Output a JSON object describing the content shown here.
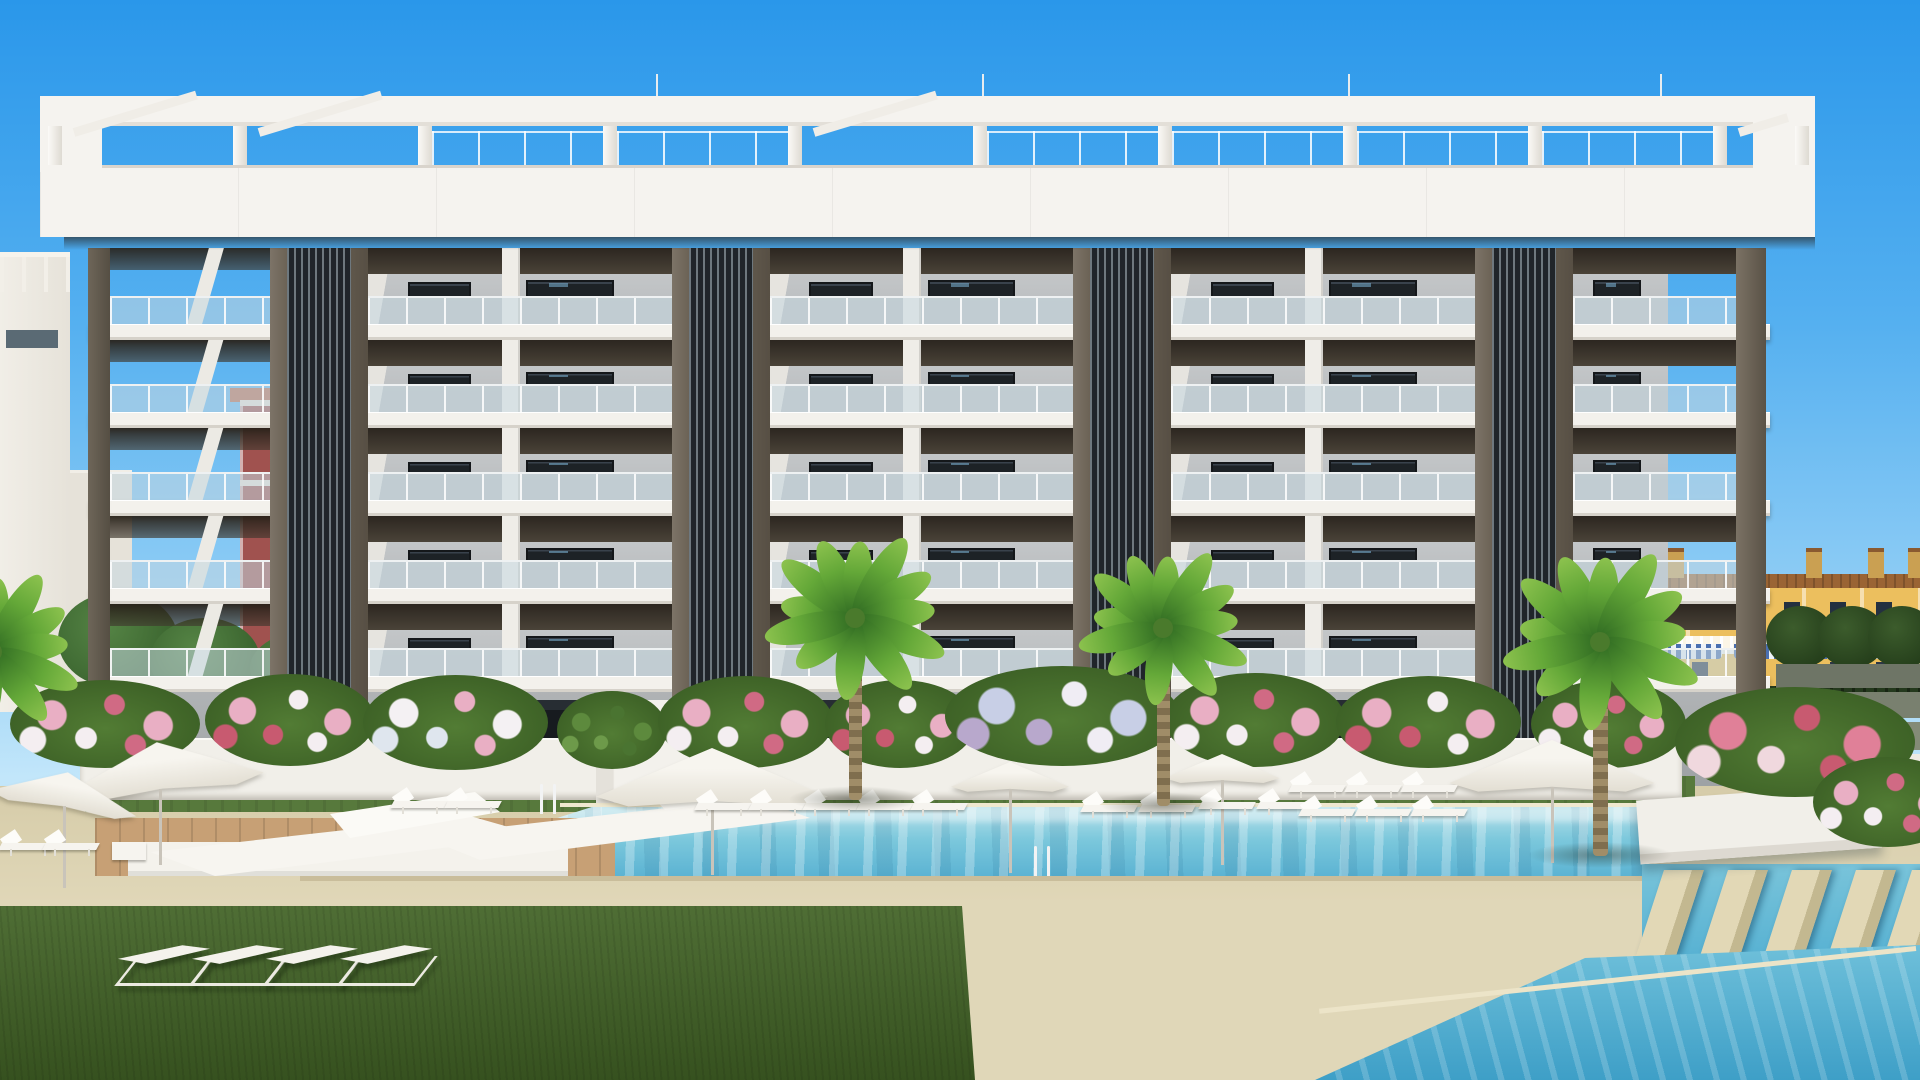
{
  "scene": {
    "type": "3d-architectural-render",
    "description": "New-build six-storey white apartment complex with dark slatted tower accents, rooftop pergola, landscaped pool area with turquoise pools, palm trees, white parasols, sun loungers, flowering hedges, lawn, and Mediterranean houses in the background",
    "visible_text": []
  },
  "palette": {
    "sky_top": "#2a97ea",
    "sky_mid": "#55b0f0",
    "sky_low": "#8fcdf5",
    "sky_horizon": "#c2e6fa",
    "building_white": "#f5f3ef",
    "slab_white": "#f3f1ec",
    "soffit_dark": "#2c2620",
    "panel_gray": "#bcbfc1",
    "window_dark": "#1d2226",
    "window_reflection_blue": "#7db7d9",
    "glass_balustrade": "rgba(197,215,224,0.55)",
    "slat_dark": "#20252a",
    "slat_light": "#6e787e",
    "pilaster_brown_light": "#7d7468",
    "pilaster_brown_dark": "#574f44",
    "pool_light": "#b9e2ea",
    "pool_mid": "#7cc8dc",
    "pool_deep": "#58b1d2",
    "corner_pool_deep": "#3e9fc7",
    "deck_beige": "#e0d7b8",
    "wood_deck": "#c7a075",
    "lawn_green": "#4f6e35",
    "hedge_green": "#46702e",
    "house_yellow": "#ecbf5e",
    "roof_brown": "#9a6434",
    "awning_blue": "#4a6fb0",
    "bg_building_maroon": "#a0524f",
    "bg_building_teal": "#74aab6"
  },
  "layout": {
    "pergola": {
      "posts_x": [
        48,
        233,
        418,
        603,
        788,
        973,
        1158,
        1343,
        1528,
        1713,
        1795
      ],
      "post_w": 14,
      "diag_sections": [
        0,
        1,
        4,
        9
      ],
      "rail_sections": [
        2,
        3,
        5,
        6,
        7,
        8
      ],
      "finials_x": [
        656,
        982,
        1348,
        1660
      ]
    },
    "building": {
      "towers_x": [
        270,
        672,
        1073,
        1475
      ],
      "bays": [
        {
          "x": 368,
          "w": 304
        },
        {
          "x": 770,
          "w": 303
        },
        {
          "x": 1171,
          "w": 304
        }
      ],
      "left_end": {
        "x": 110,
        "w": 160
      },
      "right_end": {
        "x": 1573,
        "w": 163
      },
      "corner_left": {
        "x": 88,
        "w": 22
      },
      "corner_right": {
        "x": 1736,
        "w": 30
      },
      "cells_y": [
        248,
        340,
        428,
        516,
        604
      ],
      "cells_h": [
        76,
        72,
        72,
        72,
        72
      ],
      "slabs_y": [
        324,
        412,
        500,
        588,
        676
      ]
    },
    "background_right": {
      "chimneys_x": [
        1612,
        1668,
        1742,
        1806,
        1868,
        1908
      ],
      "awnings_x": [
        1598,
        1666,
        1734,
        1802,
        1868
      ],
      "terraces": [
        {
          "y": 664,
          "h": 24,
          "c": "#6e7566"
        },
        {
          "y": 692,
          "h": 26,
          "c": "#79806f"
        },
        {
          "y": 722,
          "h": 28,
          "c": "#848b77"
        }
      ],
      "trees_x": [
        1800,
        1852,
        1902
      ]
    },
    "background_left": {
      "trees": [
        {
          "x": 118,
          "y": 640,
          "rx": 60,
          "ry": 48
        },
        {
          "x": 205,
          "y": 660,
          "rx": 55,
          "ry": 42
        },
        {
          "x": 320,
          "y": 668,
          "rx": 70,
          "ry": 40
        }
      ]
    },
    "pool_area": {
      "umbrellas": [
        {
          "cx": 160,
          "y": 742,
          "w": 205,
          "tilt": -7
        },
        {
          "cx": 64,
          "y": 772,
          "w": 150,
          "tilt": 10
        },
        {
          "cx": 712,
          "y": 748,
          "w": 232,
          "tilt": 0
        },
        {
          "cx": 1010,
          "y": 762,
          "w": 118,
          "tilt": 0
        },
        {
          "cx": 1222,
          "y": 754,
          "w": 115,
          "tilt": 0
        },
        {
          "cx": 1552,
          "y": 740,
          "w": 205,
          "tilt": 0
        }
      ],
      "poolside_loungers": [
        {
          "x": 392,
          "y": 788
        },
        {
          "x": 446,
          "y": 788
        },
        {
          "x": 696,
          "y": 790
        },
        {
          "x": 750,
          "y": 790
        },
        {
          "x": 804,
          "y": 790
        },
        {
          "x": 858,
          "y": 790
        },
        {
          "x": 912,
          "y": 790
        },
        {
          "x": 1082,
          "y": 792
        },
        {
          "x": 1140,
          "y": 792
        },
        {
          "x": 1200,
          "y": 789
        },
        {
          "x": 1258,
          "y": 789
        },
        {
          "x": 1290,
          "y": 772
        },
        {
          "x": 1346,
          "y": 772
        },
        {
          "x": 1402,
          "y": 772
        },
        {
          "x": 1300,
          "y": 796
        },
        {
          "x": 1356,
          "y": 796
        },
        {
          "x": 1412,
          "y": 796
        },
        {
          "x": 0,
          "y": 830
        },
        {
          "x": 44,
          "y": 830
        }
      ],
      "lawn_loungers": [
        {
          "x": 118,
          "y": 938
        },
        {
          "x": 192,
          "y": 938
        },
        {
          "x": 266,
          "y": 938
        },
        {
          "x": 340,
          "y": 938
        }
      ],
      "ladders": [
        {
          "x": 538,
          "y": 784
        },
        {
          "x": 1032,
          "y": 846
        }
      ],
      "stepping_stones_x": [
        8,
        72,
        136,
        200,
        256
      ],
      "bushes": [
        {
          "x": 105,
          "y": 724,
          "w": 190,
          "h": 88,
          "t": "pink"
        },
        {
          "x": 290,
          "y": 720,
          "w": 170,
          "h": 92,
          "t": "mix"
        },
        {
          "x": 455,
          "y": 722,
          "w": 185,
          "h": 95,
          "t": "white"
        },
        {
          "x": 612,
          "y": 730,
          "w": 110,
          "h": 78,
          "t": "green"
        },
        {
          "x": 745,
          "y": 722,
          "w": 175,
          "h": 92,
          "t": "pink"
        },
        {
          "x": 900,
          "y": 724,
          "w": 150,
          "h": 88,
          "t": "mix"
        },
        {
          "x": 1062,
          "y": 716,
          "w": 235,
          "h": 100,
          "t": "lavender"
        },
        {
          "x": 1255,
          "y": 720,
          "w": 180,
          "h": 94,
          "t": "pink"
        },
        {
          "x": 1428,
          "y": 722,
          "w": 185,
          "h": 92,
          "t": "mix"
        },
        {
          "x": 1608,
          "y": 724,
          "w": 155,
          "h": 88,
          "t": "pink"
        },
        {
          "x": 1795,
          "y": 742,
          "w": 240,
          "h": 110,
          "t": "bigpink"
        },
        {
          "x": 1888,
          "y": 802,
          "w": 150,
          "h": 90,
          "t": "pink"
        }
      ],
      "palms": [
        {
          "cx": 855,
          "cy": 618,
          "r": 96,
          "tw": 13,
          "tb": 800
        },
        {
          "cx": 1163,
          "cy": 628,
          "r": 90,
          "tw": 13,
          "tb": 806
        },
        {
          "cx": 1600,
          "cy": 642,
          "r": 104,
          "tw": 15,
          "tb": 856
        },
        {
          "cx": -8,
          "cy": 652,
          "r": 92,
          "tw": 0,
          "tb": 0
        }
      ]
    }
  }
}
